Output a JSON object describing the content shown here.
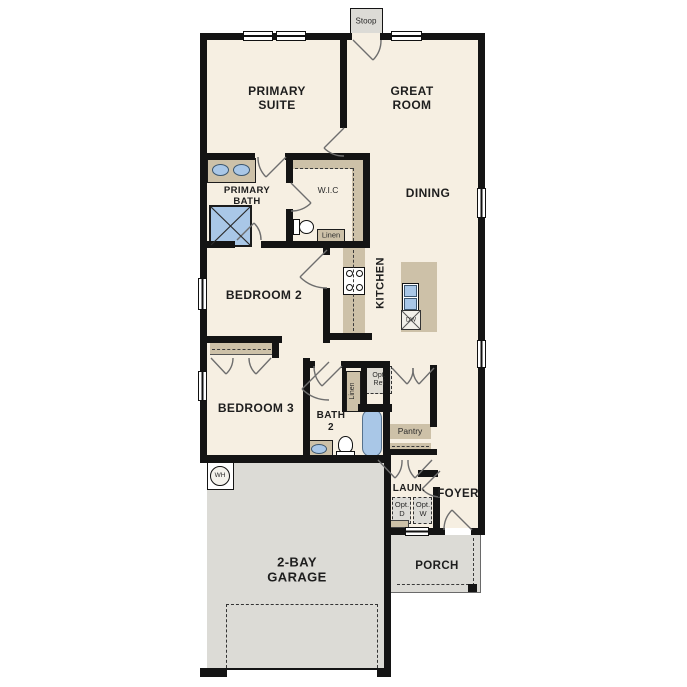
{
  "colors": {
    "wall": "#141414",
    "floor": "#f6efe2",
    "tan": "#cdc1a8",
    "blue": "#a9c7e7",
    "concrete": "#dcdbd6",
    "door_arc": "#666666"
  },
  "rooms": {
    "stoop": "Stoop",
    "primary_suite": "PRIMARY\nSUITE",
    "great_room": "GREAT\nROOM",
    "primary_bath": "PRIMARY\nBATH",
    "wic": "W.I.C",
    "dining": "DINING",
    "kitchen": "KITCHEN",
    "bedroom2": "BEDROOM 2",
    "bedroom3": "BEDROOM 3",
    "bath2": "BATH\n2",
    "laundry": "LAUN.",
    "foyer": "FOYER",
    "garage": "2-BAY\nGARAGE",
    "porch": "PORCH"
  },
  "fixtures": {
    "linen_wic": "Linen",
    "linen_bath2": "Linen",
    "opt_ref": "Opt.\nRef",
    "pantry": "Pantry",
    "opt_dryer": "Opt.\nD",
    "opt_washer": "Opt.\nW",
    "water_heater": "WH",
    "dishwasher": "DW"
  }
}
